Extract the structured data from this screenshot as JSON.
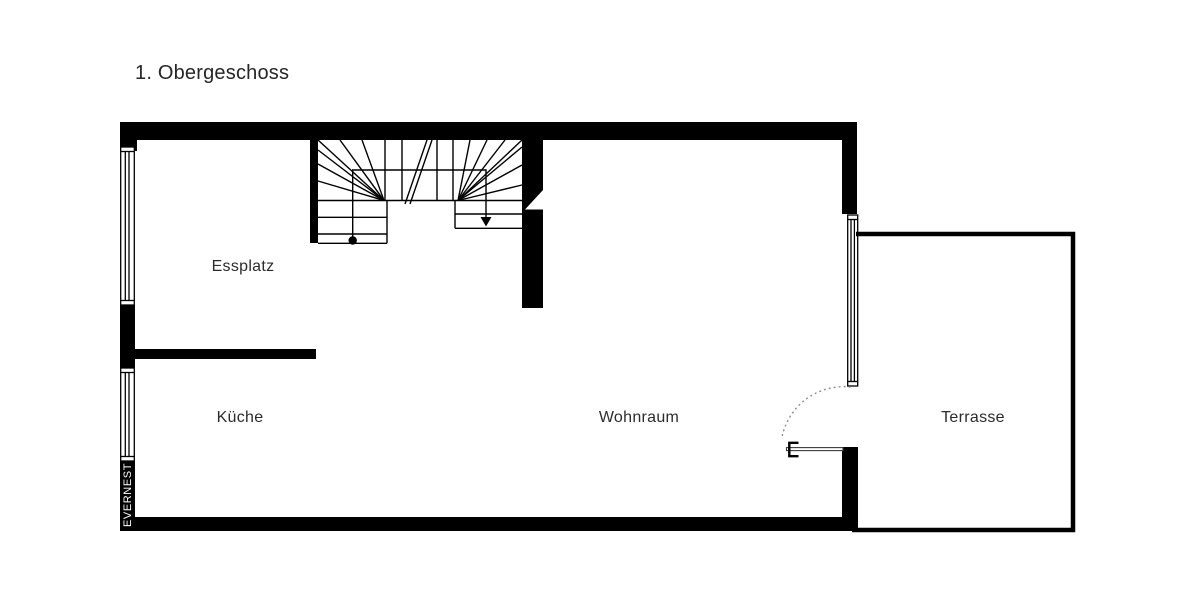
{
  "title": "1. Obergeschoss",
  "plan": {
    "rooms": [
      {
        "label": "Essplatz"
      },
      {
        "label": "Küche"
      },
      {
        "label": "Wohnraum"
      },
      {
        "label": "Terrasse"
      }
    ],
    "watermark": "EVERNEST",
    "stair_markers": [
      "walk-line-start-dot",
      "walk-line-down-arrow"
    ],
    "door": "swing-arc-to-terrace"
  },
  "colors": {
    "wall": "#000000",
    "background": "#ffffff",
    "label_text": "#2b2b2b",
    "watermark_text": "#ffffff",
    "door_arc": "#8a8a8a",
    "door_leaf": "#3a3a3a"
  }
}
